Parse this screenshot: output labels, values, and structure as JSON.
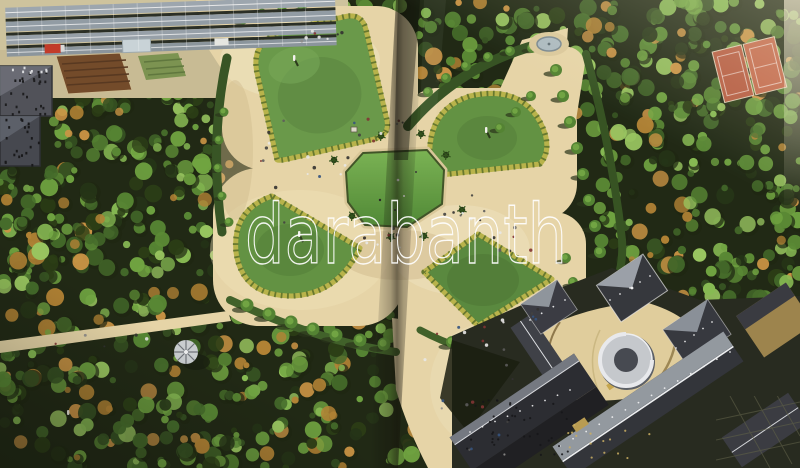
{
  "image": {
    "type": "aerial photograph printed across a two-page book spread",
    "subject": "Formal garden: four bordered lawns around an octagonal green pond, sandy esplanade, dense trees, greenhouses and tilled plots upper-left, red tennis courts upper-right, conical bandstand lower-left, large palace with slate roofs lower-right, vertical book-spine fold in the middle",
    "watermark": {
      "text": "darabanth",
      "color": "#ffffff"
    },
    "palette": {
      "sand": "#e5d4a6",
      "sand_light": "#f3e9cc",
      "lawn_green": "#5e9140",
      "pond_green": "#68a746",
      "flower_border": "#b6b146",
      "tree_dark": "#1d2d10",
      "tree_light": "#83b94f",
      "roof_slate": "#31343c",
      "roof_light": "#aab0b8",
      "tennis_court_red": "#b65a40",
      "tilled_soil": "#6e4524",
      "watermark_white": "#ffffff"
    }
  }
}
